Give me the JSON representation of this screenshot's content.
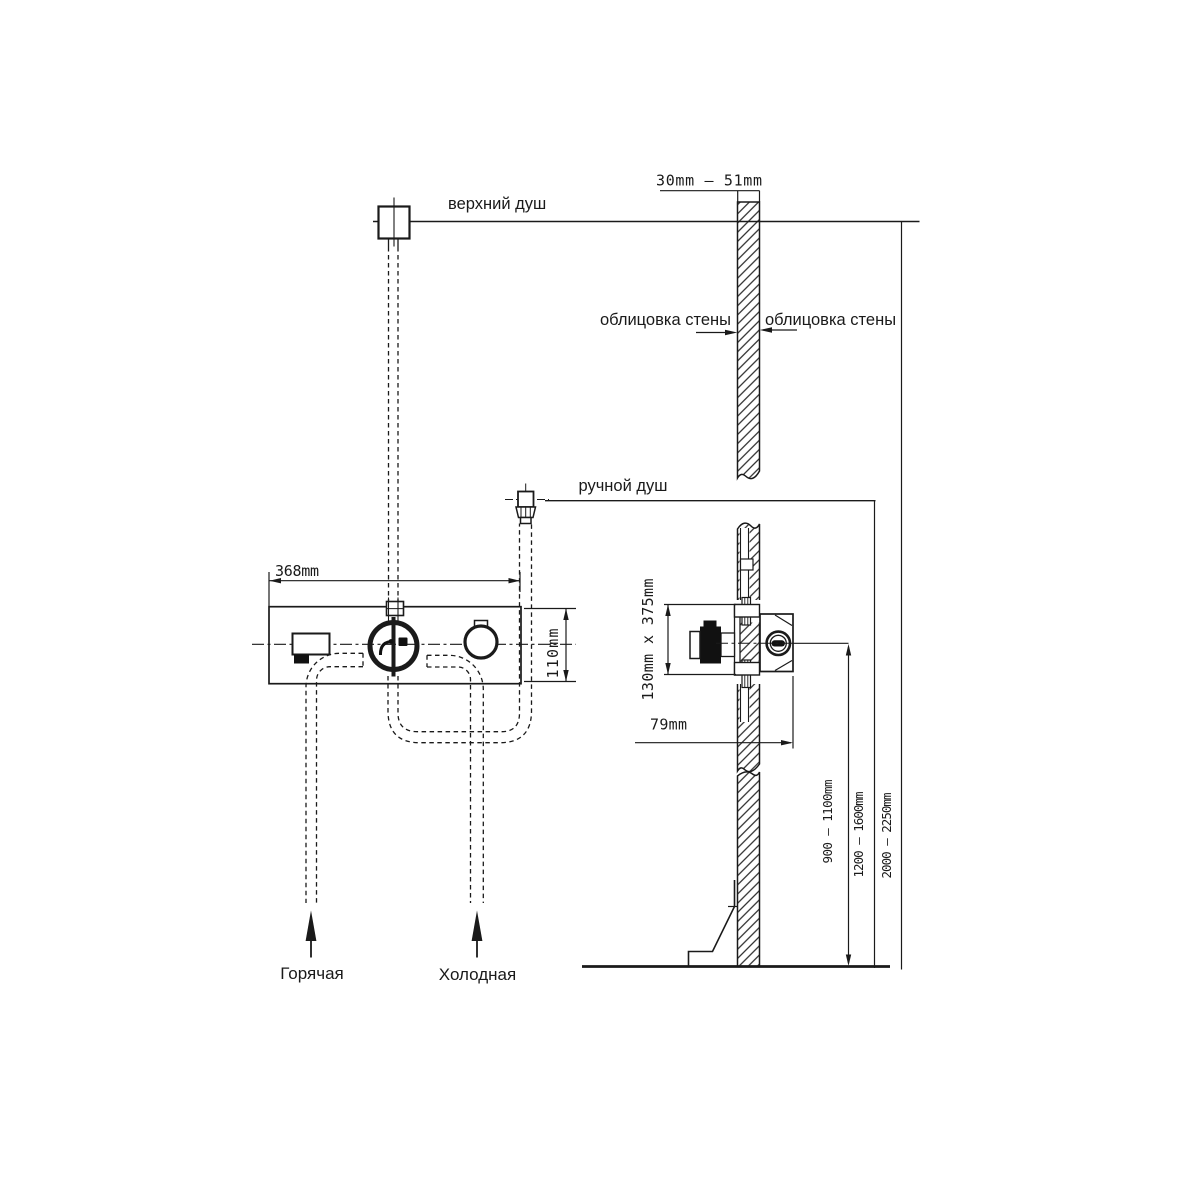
{
  "labels": {
    "upper_shower": "верхний душ",
    "hand_shower": "ручной душ",
    "wall_cladding_left": "облицовка стены",
    "wall_cladding_right": "облицовка стены",
    "hot_supply": "Горячая",
    "cold_supply": "Холодная"
  },
  "dimensions": {
    "wall_thickness": "30mm — 51mm",
    "panel_width": "368mm",
    "panel_height": "110mm",
    "rough_in_box": "130mm x 375mm",
    "box_depth": "79mm",
    "mixer_height_range": "900 — 1100mm",
    "hand_shower_height_range": "1200 — 1600mm",
    "head_shower_height_range": "2000 — 2250mm"
  },
  "colors": {
    "line": "#1a1a1a",
    "background": "#ffffff",
    "solid_fill": "#111111"
  }
}
